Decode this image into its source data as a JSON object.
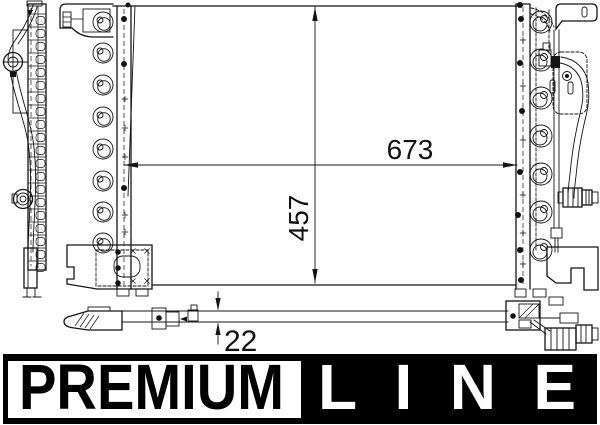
{
  "diagram": {
    "type": "technical-drawing",
    "views": [
      "side",
      "front",
      "bottom"
    ]
  },
  "dimensions": {
    "width": "673",
    "height": "457",
    "depth": "22"
  },
  "logo": {
    "premium": "PREMIUM",
    "line": "LINE",
    "bar_color": "#000000",
    "premium_box_color": "#ffffff",
    "premium_text_color": "#000000",
    "line_text_color": "#ffffff"
  },
  "colors": {
    "background": "#ffffff",
    "line": "#141414"
  }
}
